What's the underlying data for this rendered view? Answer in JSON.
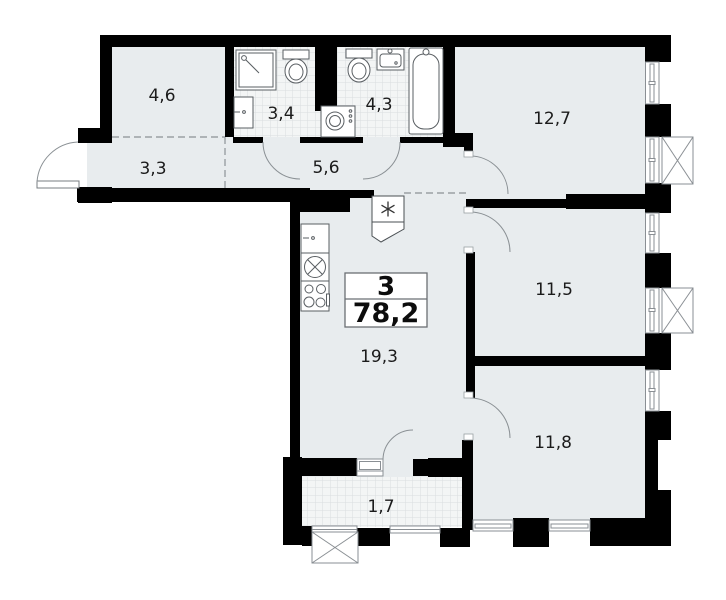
{
  "plan": {
    "title": "3-room apartment floor plan",
    "apartment": {
      "rooms_count": "3",
      "total_area": "78,2"
    },
    "rooms": [
      {
        "key": "wardrobe",
        "area": "4,6"
      },
      {
        "key": "bathroom_small",
        "area": "3,4"
      },
      {
        "key": "bathroom_large",
        "area": "4,3"
      },
      {
        "key": "bedroom_top",
        "area": "12,7"
      },
      {
        "key": "hall_entry",
        "area": "3,3"
      },
      {
        "key": "corridor",
        "area": "5,6"
      },
      {
        "key": "bedroom_middle",
        "area": "11,5"
      },
      {
        "key": "kitchen_living",
        "area": "19,3"
      },
      {
        "key": "bedroom_bottom",
        "area": "11,8"
      },
      {
        "key": "balcony",
        "area": "1,7"
      }
    ],
    "colors": {
      "wall": "#000000",
      "floor": "#e8ecee",
      "tile_floor": "#f3f5f5",
      "tile_line": "#d9dde0",
      "fixture_outline": "#5a5f63",
      "dashed_line": "#9aa0a4",
      "label_text": "#1b1b1b",
      "info_box_border": "#6b6f73"
    }
  }
}
